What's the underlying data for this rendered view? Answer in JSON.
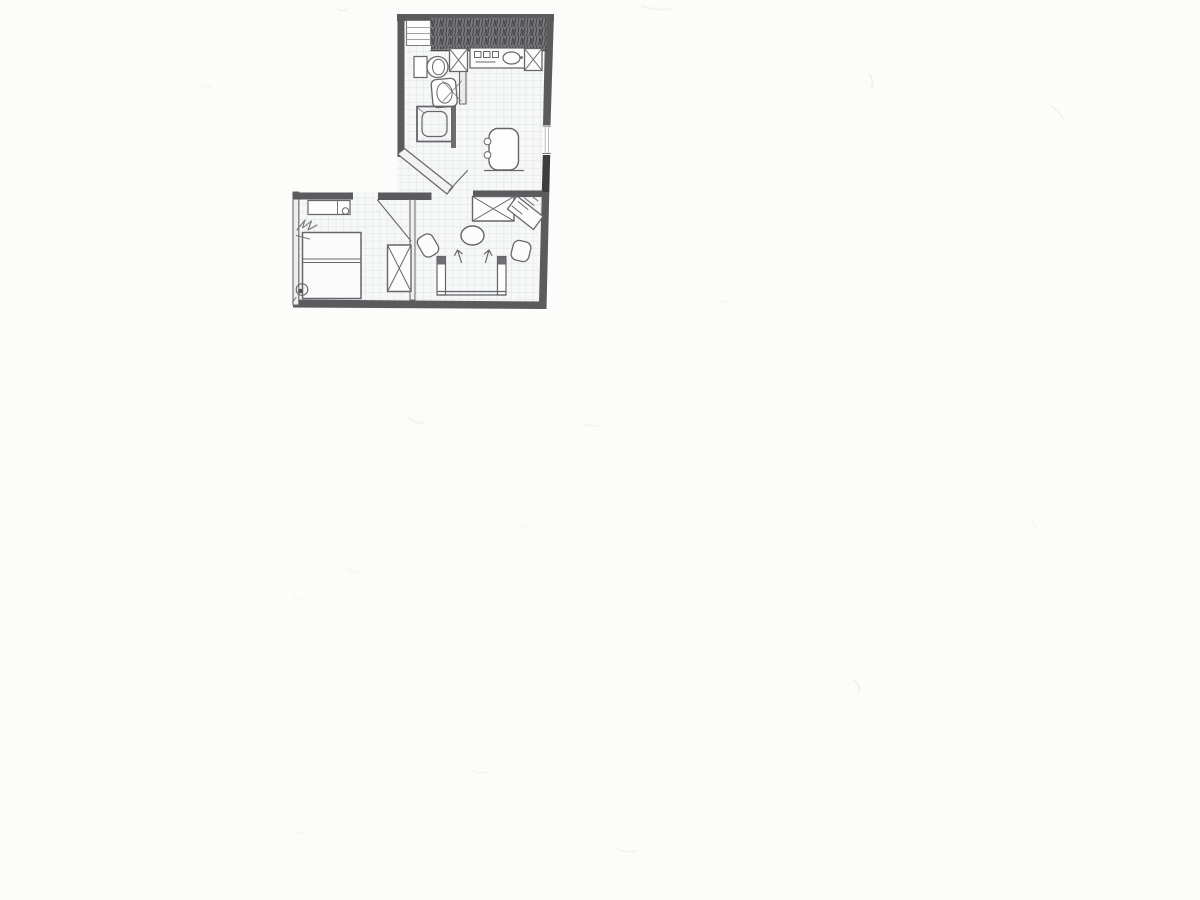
{
  "page": {
    "background": "#fcfcfb"
  },
  "plan": {
    "canvas": {
      "width": 1200,
      "height": 900
    },
    "colors": {
      "line": "#67676b",
      "wall": "#5b5b5e",
      "wall_dark": "#3c3c3f",
      "wall_light": "#f2f2f3",
      "paper": "#f6f7f7",
      "grid": "#d8dcdf",
      "hatch_bg": "#7b7b7e",
      "hatch_fg": "#47474a",
      "knob": "#6f6f73",
      "smudge": "#999999"
    },
    "grid": {
      "size": 7.3,
      "clip": "397,14 554,14 545,308.5 293,308.5 293,192 397,192"
    },
    "elements": [
      {
        "name": "top-wall",
        "shape": "rect",
        "attrs": {
          "x": 397,
          "y": 14,
          "width": 157,
          "height": 7,
          "fill": "@wall",
          "stroke": "none"
        }
      },
      {
        "name": "right-wall-upper",
        "shape": "polygon",
        "attrs": {
          "points": "545.5,14 554,14 550.5,125 543,125",
          "fill": "@wall",
          "stroke": "none"
        }
      },
      {
        "name": "right-wall-window",
        "shape": "rect",
        "attrs": {
          "x": 543,
          "y": 125,
          "width": 7.5,
          "height": 30,
          "fill": "#fdfdfd",
          "stroke": "none"
        }
      },
      {
        "name": "window-line-top",
        "shape": "path",
        "attrs": {
          "d": "M543,126 h7.5",
          "stroke-width": 1
        }
      },
      {
        "name": "window-line-bottom",
        "shape": "path",
        "attrs": {
          "d": "M542.8,153.5 h7.5",
          "stroke-width": 1
        }
      },
      {
        "name": "window-glass-lines",
        "shape": "path",
        "attrs": {
          "d": "M545.2,126 v27.5 M548.6,126 v27.5",
          "stroke": "#a8a8ab",
          "stroke-width": 0.8
        }
      },
      {
        "name": "right-wall-pier",
        "shape": "polygon",
        "attrs": {
          "points": "542.8,155 550.2,155 549.3,192 541.8,192",
          "fill": "@wall_dark",
          "stroke": "none"
        }
      },
      {
        "name": "right-wall-lower",
        "shape": "polygon",
        "attrs": {
          "points": "541.8,192 549.3,192 546.5,309 538.8,309",
          "fill": "@wall",
          "stroke": "none"
        }
      },
      {
        "name": "bottom-wall",
        "shape": "polygon",
        "attrs": {
          "points": "293,299.5 546.5,301.5 546,309 293,307.5",
          "fill": "@wall",
          "stroke": "none"
        }
      },
      {
        "name": "bedroom-left-wall",
        "shape": "rect",
        "attrs": {
          "x": 293,
          "y": 192,
          "width": 5.8,
          "height": 113,
          "fill": "#eeeeef",
          "stroke-width": 1.1
        }
      },
      {
        "name": "bedroom-top-wall-left",
        "shape": "rect",
        "attrs": {
          "x": 293,
          "y": 192.5,
          "width": 60,
          "height": 7,
          "fill": "@wall",
          "stroke": "none"
        }
      },
      {
        "name": "bedroom-top-wall-right",
        "shape": "rect",
        "attrs": {
          "x": 378,
          "y": 192.5,
          "width": 53.5,
          "height": 7.5,
          "fill": "@wall",
          "stroke": "none"
        }
      },
      {
        "name": "living-top-wall",
        "shape": "rect",
        "attrs": {
          "x": 473,
          "y": 190.5,
          "width": 69.5,
          "height": 6.5,
          "fill": "@wall",
          "stroke": "none"
        }
      },
      {
        "name": "bathroom-left-wall",
        "shape": "rect",
        "attrs": {
          "x": 397.5,
          "y": 14,
          "width": 7,
          "height": 143,
          "fill": "@wall",
          "stroke": "none"
        }
      },
      {
        "name": "chamfer-wall",
        "shape": "polygon",
        "attrs": {
          "points": "397.5,154 404.5,148.5 453,187 447,194",
          "fill": "@wall_light",
          "stroke-width": 1.2
        }
      },
      {
        "name": "bath-partition-wall",
        "shape": "rect",
        "attrs": {
          "x": 459.5,
          "y": 46,
          "width": 6.5,
          "height": 58,
          "fill": "#ececee",
          "stroke-width": 1.1
        }
      },
      {
        "name": "shower-stub-wall",
        "shape": "rect",
        "attrs": {
          "x": 451,
          "y": 103.5,
          "width": 5,
          "height": 44.5,
          "fill": "#6d6d70",
          "stroke": "none"
        }
      },
      {
        "name": "bedroom-living-divider-wall",
        "shape": "rect",
        "attrs": {
          "x": 410,
          "y": 199.5,
          "width": 5,
          "height": 100.5,
          "fill": "#efeff0",
          "stroke-width": 1
        }
      },
      {
        "name": "hatched-wall-band",
        "shape": "rect",
        "attrs": {
          "x": 431,
          "y": 17.5,
          "width": 115.5,
          "height": 32,
          "fill": "url(#scribblep)",
          "stroke": "none"
        }
      },
      {
        "name": "counter-top-line",
        "shape": "path",
        "attrs": {
          "d": "M431,50.5 h116",
          "stroke": "#4c4c4f",
          "stroke-width": 1.4
        }
      },
      {
        "name": "closet-box",
        "shape": "rect",
        "attrs": {
          "x": 406.5,
          "y": 20.5,
          "width": 24,
          "height": 25,
          "fill": "#fdfdfd",
          "stroke": "#7b7b7e",
          "stroke-width": 1.1
        }
      },
      {
        "name": "closet-shelf-lines",
        "shape": "path",
        "attrs": {
          "d": "M407,27.5 h23.5 M407,33.5 h23.5 M407,39.5 h23.5",
          "stroke": "#a0a0a3",
          "stroke-width": 0.9
        }
      },
      {
        "name": "shaft-left-box",
        "shape": "rect",
        "attrs": {
          "x": 449.5,
          "y": 48.5,
          "width": 18,
          "height": 23,
          "fill": "#fafafa",
          "stroke-width": 1.3
        }
      },
      {
        "name": "shaft-left-x",
        "shape": "path",
        "attrs": {
          "d": "M449.5,48.5 l18,23 M467.5,48.5 l-18,23",
          "stroke-width": 1
        }
      },
      {
        "name": "kitchen-counter",
        "shape": "rect",
        "attrs": {
          "x": 470,
          "y": 48,
          "width": 58,
          "height": 20,
          "fill": "#fcfcfd",
          "stroke-width": 1.3
        }
      },
      {
        "name": "stove-burners",
        "shape": "path",
        "attrs": {
          "d": "M474.5,51.5 h6.5 v6 h-6.5 z M483.5,51.5 h6.5 v6 h-6.5 z M492.5,51.5 h6 v6 h-6 z M476,62 h19",
          "stroke-width": 1
        }
      },
      {
        "name": "kitchen-sink",
        "shape": "ellipse",
        "attrs": {
          "cx": 511.5,
          "cy": 58,
          "rx": 8.5,
          "ry": 6,
          "fill": "#ffffff",
          "stroke-width": 1.2
        }
      },
      {
        "name": "sink-faucet",
        "shape": "circle",
        "attrs": {
          "cx": 521.5,
          "cy": 57.5,
          "r": 1.4,
          "fill": "@line",
          "stroke": "none"
        }
      },
      {
        "name": "shaft-right-box",
        "shape": "rect",
        "attrs": {
          "x": 524.5,
          "y": 48.5,
          "width": 17.5,
          "height": 22,
          "fill": "#fafafa",
          "stroke-width": 1.3
        }
      },
      {
        "name": "shaft-right-x",
        "shape": "path",
        "attrs": {
          "d": "M524.5,48.5 l17.5,22 M542,48.5 l-17.5,22",
          "stroke-width": 1
        }
      },
      {
        "name": "toilet-tank",
        "shape": "rect",
        "attrs": {
          "x": 414,
          "y": 56.5,
          "width": 13,
          "height": 21,
          "fill": "#ffffff",
          "stroke-width": 1.2
        }
      },
      {
        "name": "toilet-bowl",
        "shape": "circle",
        "attrs": {
          "cx": 437.5,
          "cy": 67,
          "r": 10.5,
          "fill": "#ffffff",
          "stroke-width": 1.3
        }
      },
      {
        "name": "toilet-bowl-inner",
        "shape": "ellipse",
        "attrs": {
          "cx": 438.5,
          "cy": 67,
          "rx": 6,
          "ry": 7.8,
          "stroke-width": 1
        }
      },
      {
        "name": "washbasin",
        "shape": "rect",
        "attrs": {
          "x": 432,
          "y": 79,
          "width": 24.5,
          "height": 28,
          "rx": 5,
          "fill": "#ffffff",
          "stroke-width": 1.3,
          "transform": "rotate(-5 444 93)"
        }
      },
      {
        "name": "washbasin-inner",
        "shape": "ellipse",
        "attrs": {
          "cx": 444.5,
          "cy": 93,
          "rx": 7.6,
          "ry": 10.2,
          "stroke-width": 1,
          "transform": "rotate(-5 444 93)"
        }
      },
      {
        "name": "bathroom-door-swing",
        "shape": "path",
        "attrs": {
          "d": "M461,101 L442.5,81 M443,101 L461.5,81",
          "stroke-width": 0.9,
          "opacity": 0.85
        }
      },
      {
        "name": "shower-tray",
        "shape": "rect",
        "attrs": {
          "x": 417,
          "y": 106.5,
          "width": 35,
          "height": 35,
          "stroke-width": 1.8
        }
      },
      {
        "name": "shower-tray-inner",
        "shape": "rect",
        "attrs": {
          "x": 422,
          "y": 111.5,
          "width": 25,
          "height": 25,
          "rx": 6.5,
          "stroke-width": 1.2
        }
      },
      {
        "name": "shower-corner-tick",
        "shape": "path",
        "attrs": {
          "d": "M418,108 l6,5",
          "stroke-width": 0.8
        }
      },
      {
        "name": "armchair",
        "shape": "rect",
        "attrs": {
          "x": 489,
          "y": 128.5,
          "width": 29.5,
          "height": 41.5,
          "rx": 9,
          "fill": "#fdfdfe",
          "stroke-width": 1.4
        }
      },
      {
        "name": "armchair-knob-top",
        "shape": "circle",
        "attrs": {
          "cx": 487.5,
          "cy": 141.5,
          "r": 3.4,
          "fill": "#fdfdfe",
          "stroke-width": 1
        }
      },
      {
        "name": "armchair-knob-bottom",
        "shape": "circle",
        "attrs": {
          "cx": 487.5,
          "cy": 155,
          "r": 3.4,
          "fill": "#fdfdfe",
          "stroke-width": 1
        }
      },
      {
        "name": "armchair-base-line",
        "shape": "path",
        "attrs": {
          "d": "M484.5,170.5 h39",
          "stroke-width": 1.2
        }
      },
      {
        "name": "living-door-leaf",
        "shape": "path",
        "attrs": {
          "d": "M449,190.5 L467.5,170.5",
          "stroke-width": 1.1
        }
      },
      {
        "name": "bedroom-door-leaf",
        "shape": "path",
        "attrs": {
          "d": "M377.5,200 L411,241",
          "stroke-width": 1.1
        }
      },
      {
        "name": "dresser",
        "shape": "rect",
        "attrs": {
          "x": 308,
          "y": 200.5,
          "width": 42,
          "height": 14,
          "fill": "#fdfdfd",
          "stroke-width": 1.2
        }
      },
      {
        "name": "dresser-divider",
        "shape": "path",
        "attrs": {
          "d": "M337.5,200.5 v14",
          "stroke-width": 0.9
        }
      },
      {
        "name": "dresser-knob",
        "shape": "circle",
        "attrs": {
          "cx": 345.5,
          "cy": 211,
          "r": 3.2,
          "fill": "#fdfdfd",
          "stroke-width": 1
        }
      },
      {
        "name": "double-bed",
        "shape": "rect",
        "attrs": {
          "x": 302.5,
          "y": 232.5,
          "width": 58.5,
          "height": 66,
          "fill": "#fbfbfc",
          "stroke-width": 1.5
        }
      },
      {
        "name": "bed-pillow-lines",
        "shape": "path",
        "attrs": {
          "d": "M302.5,259 h58.5 M302.5,262.5 h58.5",
          "stroke-width": 1
        }
      },
      {
        "name": "wall-scribble-mark",
        "shape": "path",
        "attrs": {
          "d": "M297,230 l8,-10 l-2.5,8 l9,-7 l-3.5,9 l9,-5 M296.5,235.5 l13,3.5",
          "stroke": "#77777b",
          "stroke-width": 1.1
        }
      },
      {
        "name": "corner-circle-mark",
        "shape": "circle",
        "attrs": {
          "cx": 302,
          "cy": 289.5,
          "r": 5.8,
          "stroke-width": 1.1
        }
      },
      {
        "name": "corner-dot-mark",
        "shape": "circle",
        "attrs": {
          "cx": 300.5,
          "cy": 291,
          "r": 2.3,
          "fill": "#555558",
          "stroke": "none"
        }
      },
      {
        "name": "corner-tick-mark",
        "shape": "path",
        "attrs": {
          "d": "M296,297.5 l-3.5,4.5",
          "stroke-width": 1
        }
      },
      {
        "name": "wardrobe",
        "shape": "rect",
        "attrs": {
          "x": 387.5,
          "y": 245,
          "width": 23.5,
          "height": 46.5,
          "fill": "#fcfcfd",
          "stroke-width": 1.4
        }
      },
      {
        "name": "wardrobe-x",
        "shape": "path",
        "attrs": {
          "d": "M387.5,245 L411,291.5 M411,245 L387.5,291.5",
          "stroke-width": 1
        }
      },
      {
        "name": "crossed-table",
        "shape": "rect",
        "attrs": {
          "x": 472.5,
          "y": 196.5,
          "width": 41.5,
          "height": 24.5,
          "fill": "#fcfcfd",
          "stroke-width": 1.4
        }
      },
      {
        "name": "crossed-table-x",
        "shape": "path",
        "attrs": {
          "d": "M472.5,196.5 l41.5,24.5 M514,196.5 l-41.5,24.5",
          "stroke-width": 1
        }
      },
      {
        "name": "tilted-bench",
        "shape": "polygon",
        "attrs": {
          "points": "517,196 543,216.5 533.5,229.5 507.5,209",
          "fill": "#fcfcfd",
          "stroke-width": 1.3
        }
      },
      {
        "name": "tilted-bench-hatch",
        "shape": "path",
        "attrs": {
          "d": "M512,206 l10,8 M518,201.5 l10,8 M524,197.5 l10,8 M530,194.5 l8,6.5",
          "stroke-width": 0.9
        }
      },
      {
        "name": "round-table",
        "shape": "ellipse",
        "attrs": {
          "cx": 472.5,
          "cy": 235.5,
          "rx": 11.5,
          "ry": 9.5,
          "fill": "#fcfcfd",
          "stroke-width": 1.4
        }
      },
      {
        "name": "chair-left",
        "shape": "rect",
        "attrs": {
          "x": -8.5,
          "y": -11,
          "width": 17,
          "height": 22,
          "rx": 6,
          "fill": "#fcfcfd",
          "stroke-width": 1.3,
          "transform": "translate(428,245.5) rotate(-30)"
        }
      },
      {
        "name": "chair-right",
        "shape": "rect",
        "attrs": {
          "x": -9,
          "y": -10,
          "width": 18,
          "height": 20,
          "rx": 6,
          "fill": "#fcfcfd",
          "stroke-width": 1.3,
          "transform": "translate(521,251) rotate(14)"
        }
      },
      {
        "name": "direction-arrow-left",
        "shape": "path",
        "attrs": {
          "d": "M461.5,262.5 L457.5,250 l-2.8,5.2 M457.5,250 l4.6,3.6",
          "stroke-width": 1.2
        }
      },
      {
        "name": "direction-arrow-right",
        "shape": "path",
        "attrs": {
          "d": "M485.5,262.5 L489,250 l-4.6,3.9 M489,250 l2.7,5.2",
          "stroke-width": 1.2
        }
      },
      {
        "name": "sofa-left-armrest",
        "shape": "rect",
        "attrs": {
          "x": 437,
          "y": 256.5,
          "width": 8.5,
          "height": 38.5,
          "fill": "#fdfdfd",
          "stroke-width": 1.2
        }
      },
      {
        "name": "sofa-left-knob",
        "shape": "rect",
        "attrs": {
          "x": 437.5,
          "y": 257,
          "width": 7.5,
          "height": 7.5,
          "fill": "@knob",
          "stroke": "none"
        }
      },
      {
        "name": "sofa-right-armrest",
        "shape": "rect",
        "attrs": {
          "x": 497.5,
          "y": 256.5,
          "width": 8.5,
          "height": 38.5,
          "fill": "#fdfdfd",
          "stroke-width": 1.2
        }
      },
      {
        "name": "sofa-right-knob",
        "shape": "rect",
        "attrs": {
          "x": 498,
          "y": 257,
          "width": 7.5,
          "height": 7.5,
          "fill": "@knob",
          "stroke": "none"
        }
      },
      {
        "name": "sofa-seat-lines",
        "shape": "path",
        "attrs": {
          "d": "M437,291.5 h69 M437,295 h69",
          "stroke-width": 1.3
        }
      }
    ],
    "smudges": [
      {
        "d": "M338,9 q4,3 8,1",
        "o": 0.12,
        "w": 1.6
      },
      {
        "d": "M642,6 q14,5 30,3",
        "o": 0.1,
        "w": 1.8
      },
      {
        "d": "M869,74 q6,8 2,14",
        "o": 0.13,
        "w": 1.8
      },
      {
        "d": "M1051,106 q8,6 12,12",
        "o": 0.1,
        "w": 1.6
      },
      {
        "d": "M203,86 q5,2 8,0",
        "o": 0.08,
        "w": 1.4
      },
      {
        "d": "M409,418 q8,6 14,5",
        "o": 0.12,
        "w": 1.8
      },
      {
        "d": "M582,424 q10,3 18,1",
        "o": 0.09,
        "w": 1.6
      },
      {
        "d": "M348,569 q5,4 9,3",
        "o": 0.09,
        "w": 1.4
      },
      {
        "d": "M522,526 q6,2 10,2",
        "o": 0.08,
        "w": 1.4
      },
      {
        "d": "M293,596 q4,3 7,2",
        "o": 0.08,
        "w": 1.4
      },
      {
        "d": "M854,680 q8,7 4,13",
        "o": 0.12,
        "w": 1.8
      },
      {
        "d": "M471,770 q9,4 16,2",
        "o": 0.09,
        "w": 1.6
      },
      {
        "d": "M293,831 q5,3 9,2",
        "o": 0.08,
        "w": 1.4
      },
      {
        "d": "M618,849 q10,4 18,2",
        "o": 0.1,
        "w": 1.6
      },
      {
        "d": "M1032,520 q5,5 3,10",
        "o": 0.07,
        "w": 1.4
      },
      {
        "d": "M720,300 q6,3 10,2",
        "o": 0.06,
        "w": 1.4
      }
    ]
  }
}
